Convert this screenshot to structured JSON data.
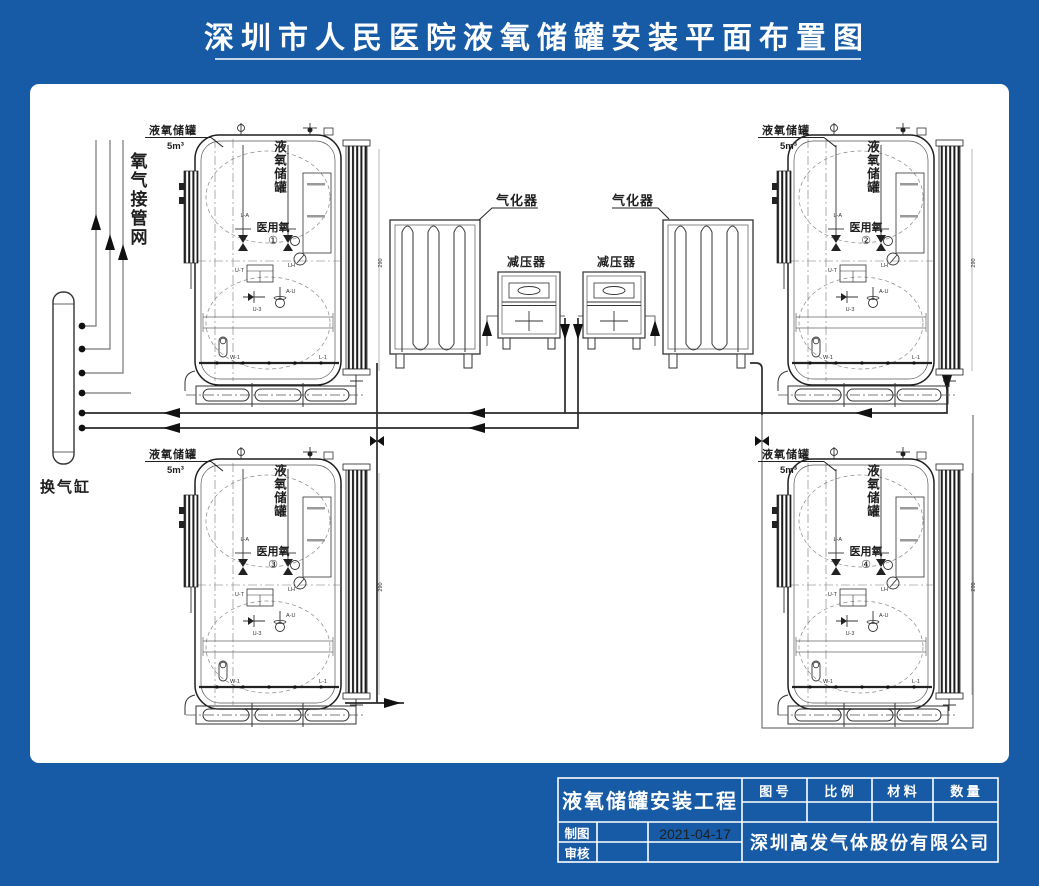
{
  "title": "深圳市人民医院液氧储罐安装平面布置图",
  "drawing": {
    "oxygen_network_label": "氧气接管网",
    "exchange_cylinder_label": "换气缸",
    "vaporizer_label": "气化器",
    "regulator_label": "减压器",
    "tank_callout": {
      "name": "液氧储罐",
      "volume": "5m³"
    },
    "tank_body_label": "液氧储罐",
    "tank_use_label": "医用氧",
    "tanks": [
      {
        "number": "①"
      },
      {
        "number": "②"
      },
      {
        "number": "③"
      },
      {
        "number": "④"
      }
    ],
    "tags": {
      "l_a": "L-A",
      "u_t": "U-T",
      "u_3": "U-3",
      "a_u": "A-U",
      "w_1": "W-1",
      "l_1": "L-1",
      "lh": "LH",
      "dim": "290"
    }
  },
  "title_block": {
    "project": "液氧储罐安装工程",
    "col_headers": [
      "图 号",
      "比 例",
      "材 料",
      "数 量"
    ],
    "drawn_label": "制图",
    "checked_label": "审核",
    "date": "2021-04-17",
    "company": "深圳高发气体股份有限公司"
  },
  "colors": {
    "background": "#175aa5",
    "panel": "#ffffff",
    "line": "#222222",
    "title_text": "#ffffff"
  }
}
